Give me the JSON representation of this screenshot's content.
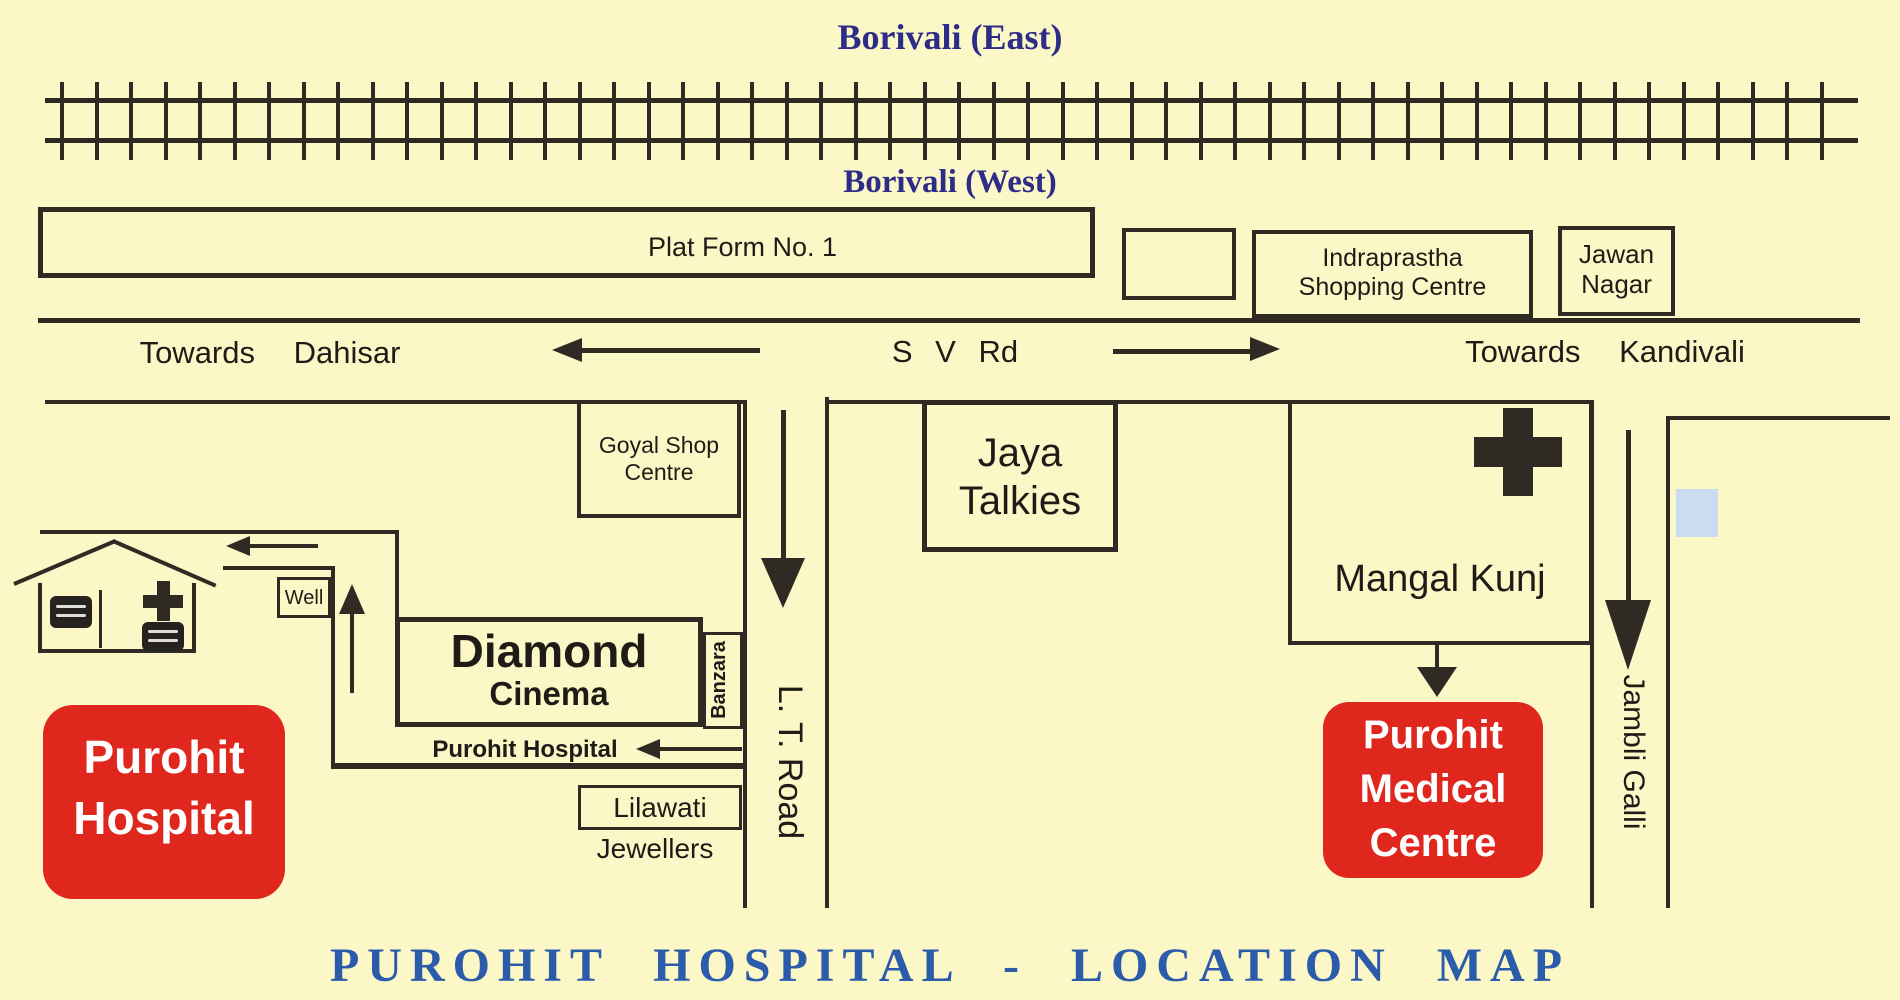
{
  "title": "PUROHIT HOSPITAL - LOCATION MAP",
  "stations": {
    "east": "Borivali (East)",
    "west": "Borivali (West)"
  },
  "platform": {
    "label": "Plat Form No. 1"
  },
  "shops": {
    "indraprastha_l1": "Indraprastha",
    "indraprastha_l2": "Shopping  Centre",
    "jawan_l1": "Jawan",
    "jawan_l2": "Nagar",
    "goyal_l1": "Goyal Shop",
    "goyal_l2": "Centre",
    "jaya_l1": "Jaya",
    "jaya_l2": "Talkies",
    "mangal": "Mangal Kunj",
    "diamond_l1": "Diamond",
    "diamond_l2": "Cinema",
    "banzara": "Banzara",
    "well": "Well",
    "lilawati_l1": "Lilawati",
    "lilawati_l2": "Jewellers"
  },
  "roads": {
    "sv_road": "S V Rd",
    "towards_dahisar": "Towards Dahisar",
    "towards_kandivali": "Towards Kandivali",
    "lt_road": "L. T. Road",
    "jambli_galli": "Jambli Galli",
    "purohit_lane": "Purohit Hospital"
  },
  "hospital": {
    "l1": "Purohit",
    "l2": "Hospital"
  },
  "medical_centre": {
    "l1": "Purohit",
    "l2": "Medical",
    "l3": "Centre"
  },
  "colors": {
    "background": "#fbf7c6",
    "line": "#2f2b24",
    "station_navy": "#2d2c88",
    "title_blue": "#2b5cab",
    "hospital_red": "#e0271e",
    "plot_blue": "#cadcf2"
  }
}
